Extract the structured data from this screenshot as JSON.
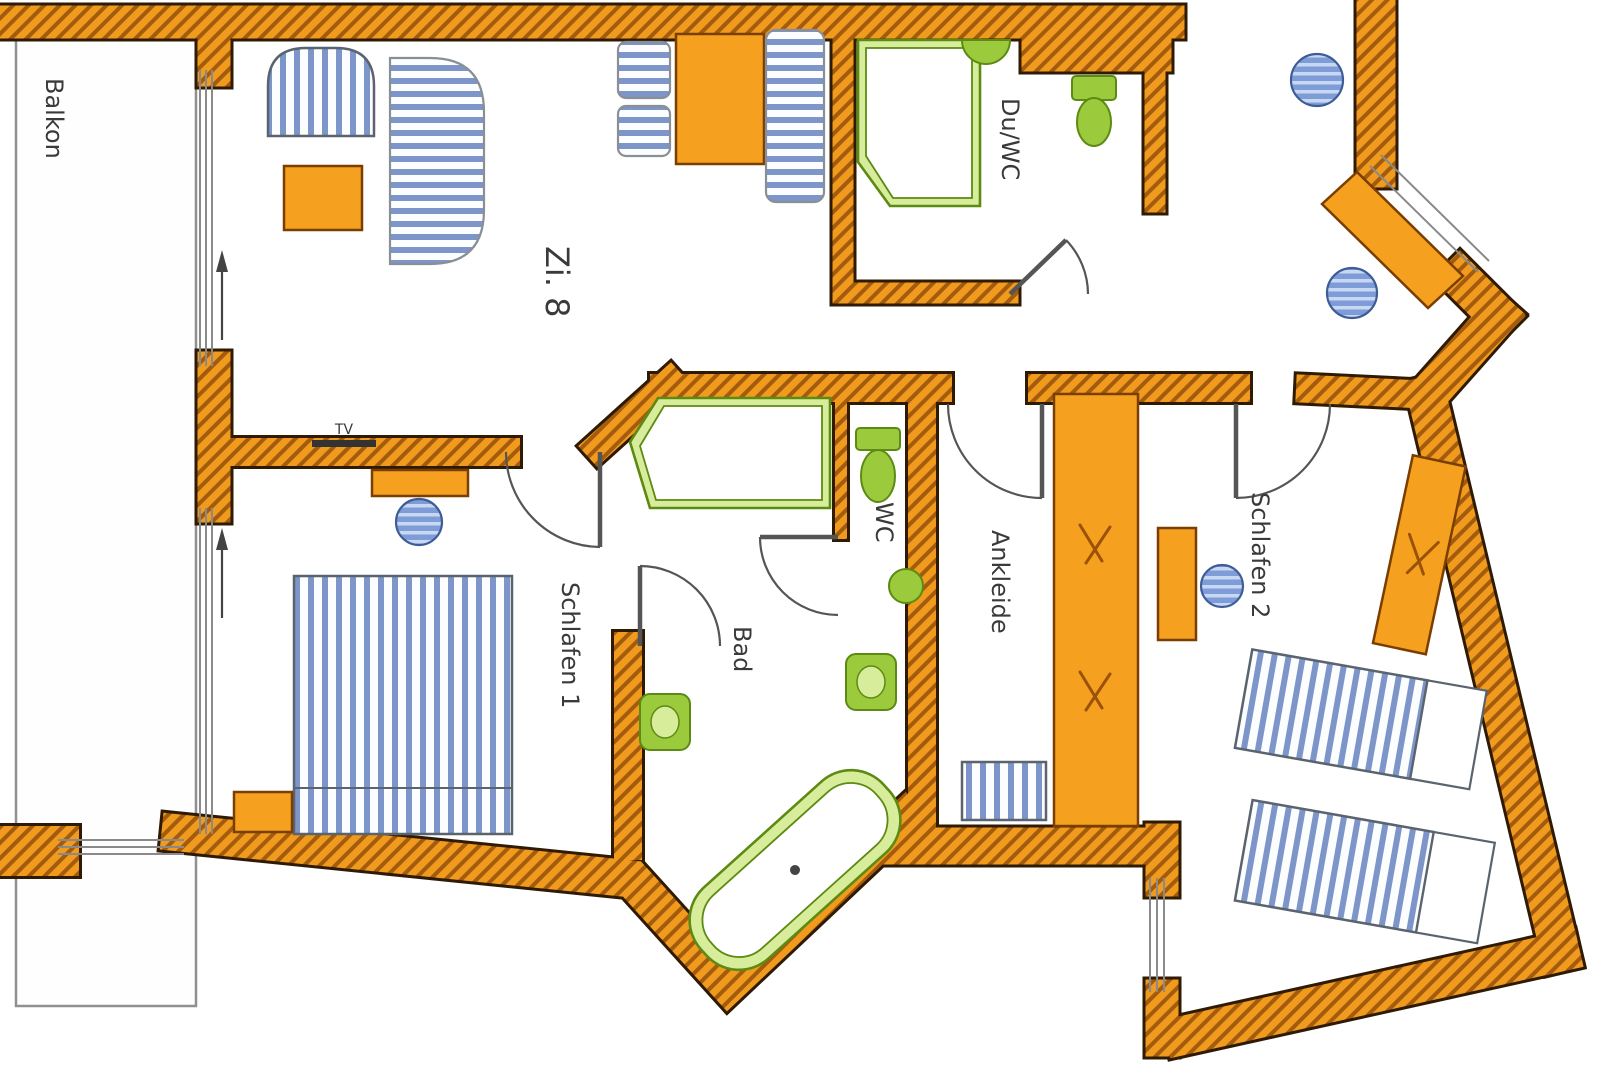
{
  "plan": {
    "rooms": {
      "balkon": {
        "label": "Balkon"
      },
      "zi8": {
        "label": "Zi. 8"
      },
      "duwc": {
        "label": "Du/WC"
      },
      "schlafen1": {
        "label": "Schlafen 1"
      },
      "bad": {
        "label": "Bad"
      },
      "wc": {
        "label": "WC"
      },
      "ankleide": {
        "label": "Ankleide"
      },
      "schlafen2": {
        "label": "Schlafen 2"
      }
    },
    "annotations": {
      "tv": {
        "label": "TV"
      }
    },
    "colors": {
      "wall_fill": "#F09A1E",
      "wall_hatch": "#A35B0D",
      "wall_outline": "#2F1B04",
      "furniture_orange": "#F6A01F",
      "fabric_stripe_blue": "#7D95C8",
      "fixture_green_light": "#D8ED9C",
      "fixture_green": "#9BCB3C",
      "fixture_green_dark": "#5C8A12",
      "stool_blue": "#7E9CD8",
      "line_gray": "#8A8A8A"
    }
  }
}
